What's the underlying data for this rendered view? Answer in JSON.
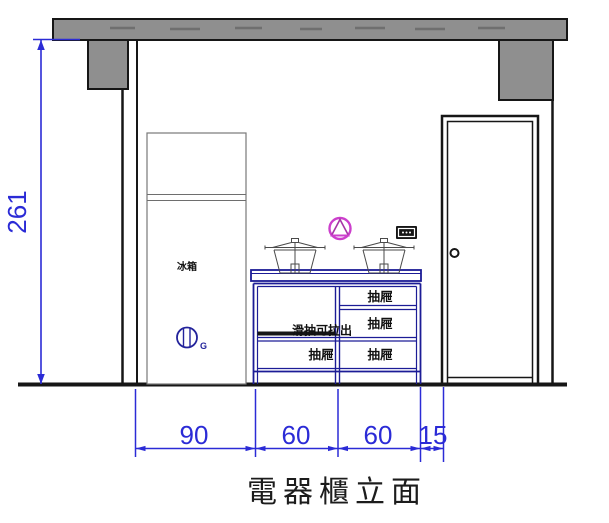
{
  "drawing": {
    "title": "電器櫃立面",
    "labels": {
      "fridge": "冰箱",
      "drawer": "抽屜",
      "sliding_shelf": "滑抽可拉出",
      "ground_mark": "G"
    },
    "dimensions": {
      "height": "261",
      "widths": [
        "90",
        "60",
        "60",
        "15"
      ]
    },
    "colors": {
      "dimension_blue": "#2b2bd6",
      "cabinet_navy": "#1c1c96",
      "wall_gray": "#8f8f8f",
      "line_black": "#161616",
      "symbol_magenta": "#cc3fcc"
    },
    "symbols": [
      "gas-hob-symbol",
      "power-outlet-icon",
      "ground-circle-symbol",
      "pot-icon",
      "door-knob-icon"
    ]
  }
}
